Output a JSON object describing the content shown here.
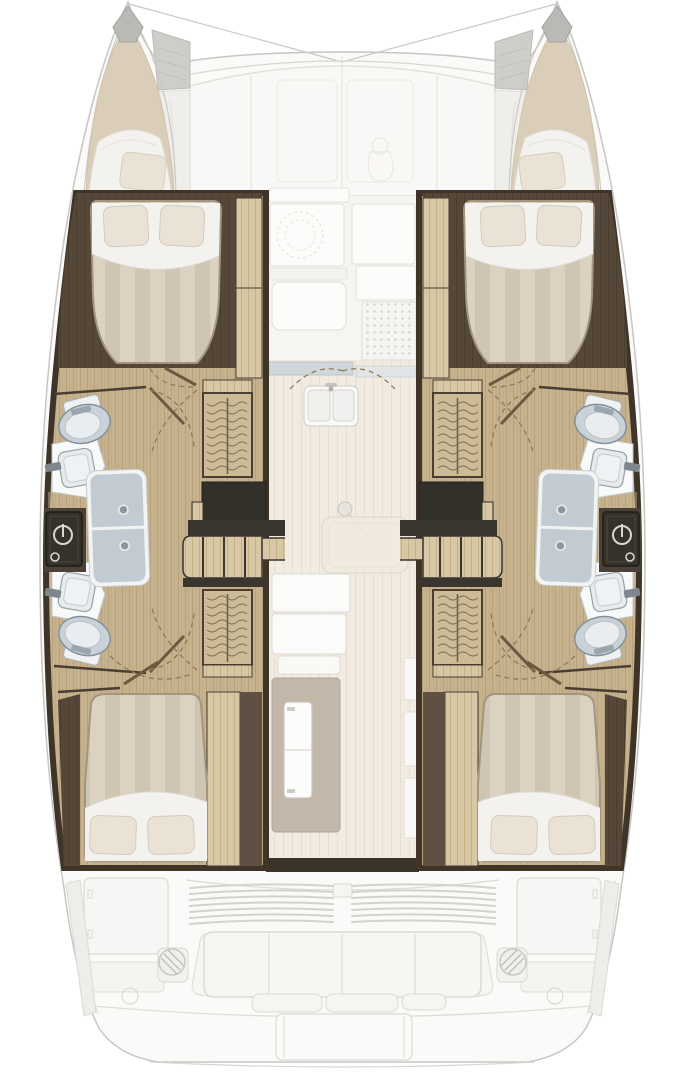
{
  "page": {
    "title": "Catamaran interior layout floor plan, top view",
    "background": "#ffffff"
  },
  "regions": {
    "port_hull": "Port hull: bow berth, forward double cabin, two bathrooms with shower, aft double cabin",
    "starboard_hull": "Starboard hull (mirror layout): bow berth, forward double cabin, two bathrooms with shower, aft double cabin",
    "forepeak": "Bow peak berth with cushion and pillow",
    "forward_cabin": "Forward double cabin with island bed",
    "bathroom": "Bathroom with toilet, washbasin and shared shower column",
    "wardrobe": "Wardrobe with hanging rail",
    "companionway": "Companionway steps down into hull",
    "aft_cabin": "Aft double cabin with island bed",
    "salon": "Salon and galley on main deck",
    "front_lounge": "Foredeck lounge cushions",
    "cockpit": "Aft cockpit with bench seating and winches",
    "transom": "Transom platform and steps"
  },
  "features": {
    "double_cabins": 4,
    "bow_berths": 2,
    "toilets": 4,
    "washbasins": 4,
    "shower_columns": 2,
    "wardrobes": 4,
    "electrical_panels": 2,
    "cockpit_winches": 2
  },
  "icons": {
    "power_icon": "power symbol on dark electrical panel",
    "door_swing_icon": "dashed quarter-circle door swing arc",
    "hanger_rail_icon": "wavy lines of clothes hangers on rail",
    "winch_icon": "hatched circle",
    "cooktop_grate_icon": "dotted grid grate"
  },
  "palette": {
    "hull_line_gray": "#c6c6c3",
    "boat_fill": "#fbfaf8",
    "floor_wood_tan": "#c7b28e",
    "plank_wood_light": "#d7c7a5",
    "cabin_wall_dark": "#4a3e31",
    "step_charcoal": "#332f29",
    "mattress_stripe_light": "#dcd2c2",
    "mattress_stripe_dark": "#cfc5b3",
    "linen_white": "#f3f2ef",
    "pillow_cream": "#eae3d5",
    "fixture_blue_gray": "#c9d2d8",
    "shower_glass": "#c2cbd1",
    "counter_blue": "#cdd5da",
    "taupe_mat": "#c3b7a9",
    "door_arc_brown": "#8f7a58",
    "faint_furniture": "#f8f7f5"
  }
}
